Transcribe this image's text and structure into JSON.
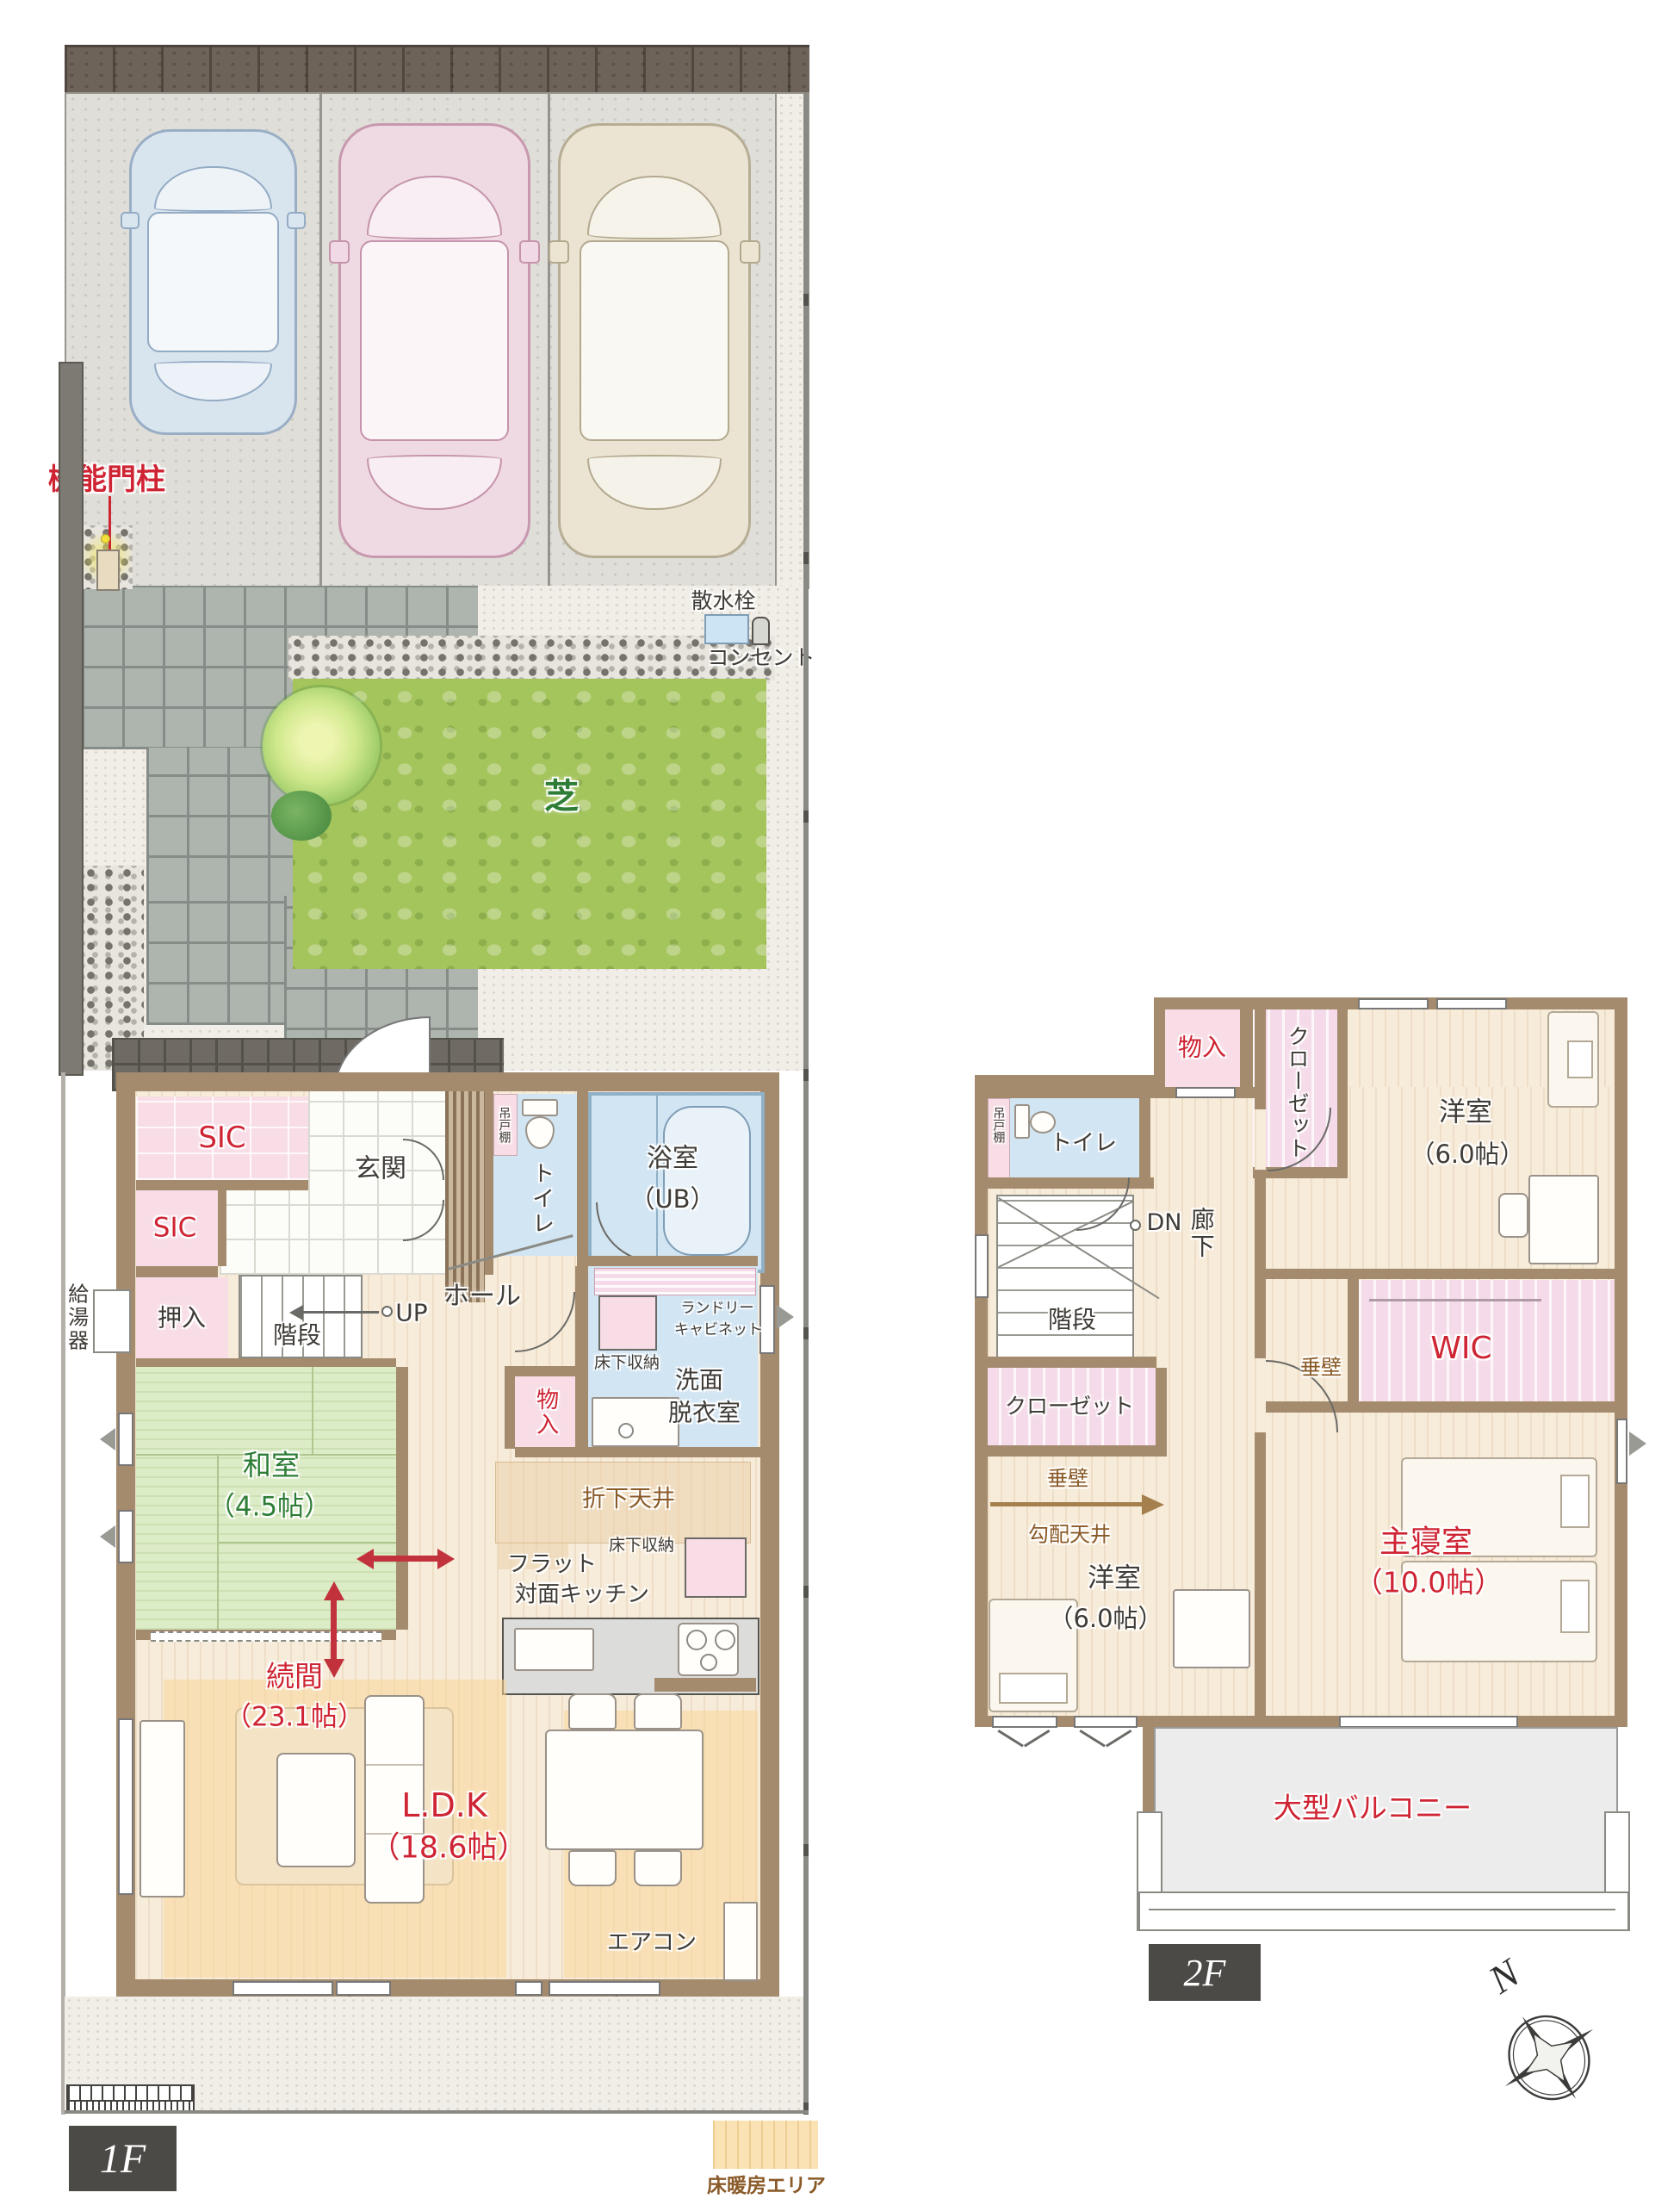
{
  "colors": {
    "wall": "#a48b6e",
    "accent_red": "#cf2433",
    "tatami_green": "#2e7d36",
    "note_brown": "#8a5a28",
    "floor_heating": "#fbe2b4",
    "lawn": "#a4c45c",
    "water_blue": "#d2e5f3",
    "room_pink": "#f8dde6",
    "tag_gray": "#4b4a46"
  },
  "site": {
    "gate_post": "機能門柱",
    "sprinkler": "散水栓",
    "outlet": "コンセント",
    "lawn": "芝",
    "water_heater": "給湯器"
  },
  "floor1": {
    "tag": "1F",
    "sic_upper": "SIC",
    "sic_lower": "SIC",
    "genkan": "玄関",
    "hanging_shelf": "吊戸棚",
    "toilet": "トイレ",
    "bath_line1": "浴室",
    "bath_line2": "（UB）",
    "laundry_line1": "ランドリー",
    "laundry_line2": "キャビネット",
    "underfloor_wash": "床下収納",
    "wash_line1": "洗面",
    "wash_line2": "脱衣室",
    "storage": "物入",
    "oshiire": "押入",
    "stairs": "階段",
    "up": "UP",
    "hall": "ホール",
    "washitsu_line1": "和室",
    "washitsu_line2": "（4.5帖）",
    "dropped_ceiling": "折下天井",
    "underfloor_kitchen": "床下収納",
    "kitchen_line1": "フラット",
    "kitchen_line2": "対面キッチン",
    "tsuzukima_line1": "続間",
    "tsuzukima_line2": "（23.1帖）",
    "ldk_line1": "L.D.K",
    "ldk_line2": "（18.6帖）",
    "aircon": "エアコン"
  },
  "floor2": {
    "tag": "2F",
    "storage": "物入",
    "closet_upper": "クローゼット",
    "bedroom_tr_line1": "洋室",
    "bedroom_tr_line2": "（6.0帖）",
    "hanging_shelf": "吊戸棚",
    "toilet": "トイレ",
    "dn": "DN",
    "corridor": "廊下",
    "stairs": "階段",
    "closet_left": "クローゼット",
    "tarekabe_left": "垂壁",
    "tarekabe_right": "垂壁",
    "sloped_ceiling": "勾配天井",
    "bedroom_bl_line1": "洋室",
    "bedroom_bl_line2": "（6.0帖）",
    "wic": "WIC",
    "master_line1": "主寝室",
    "master_line2": "（10.0帖）",
    "balcony": "大型バルコニー",
    "compass_north": "N"
  },
  "legend": {
    "floor_heating": "床暖房エリア"
  }
}
